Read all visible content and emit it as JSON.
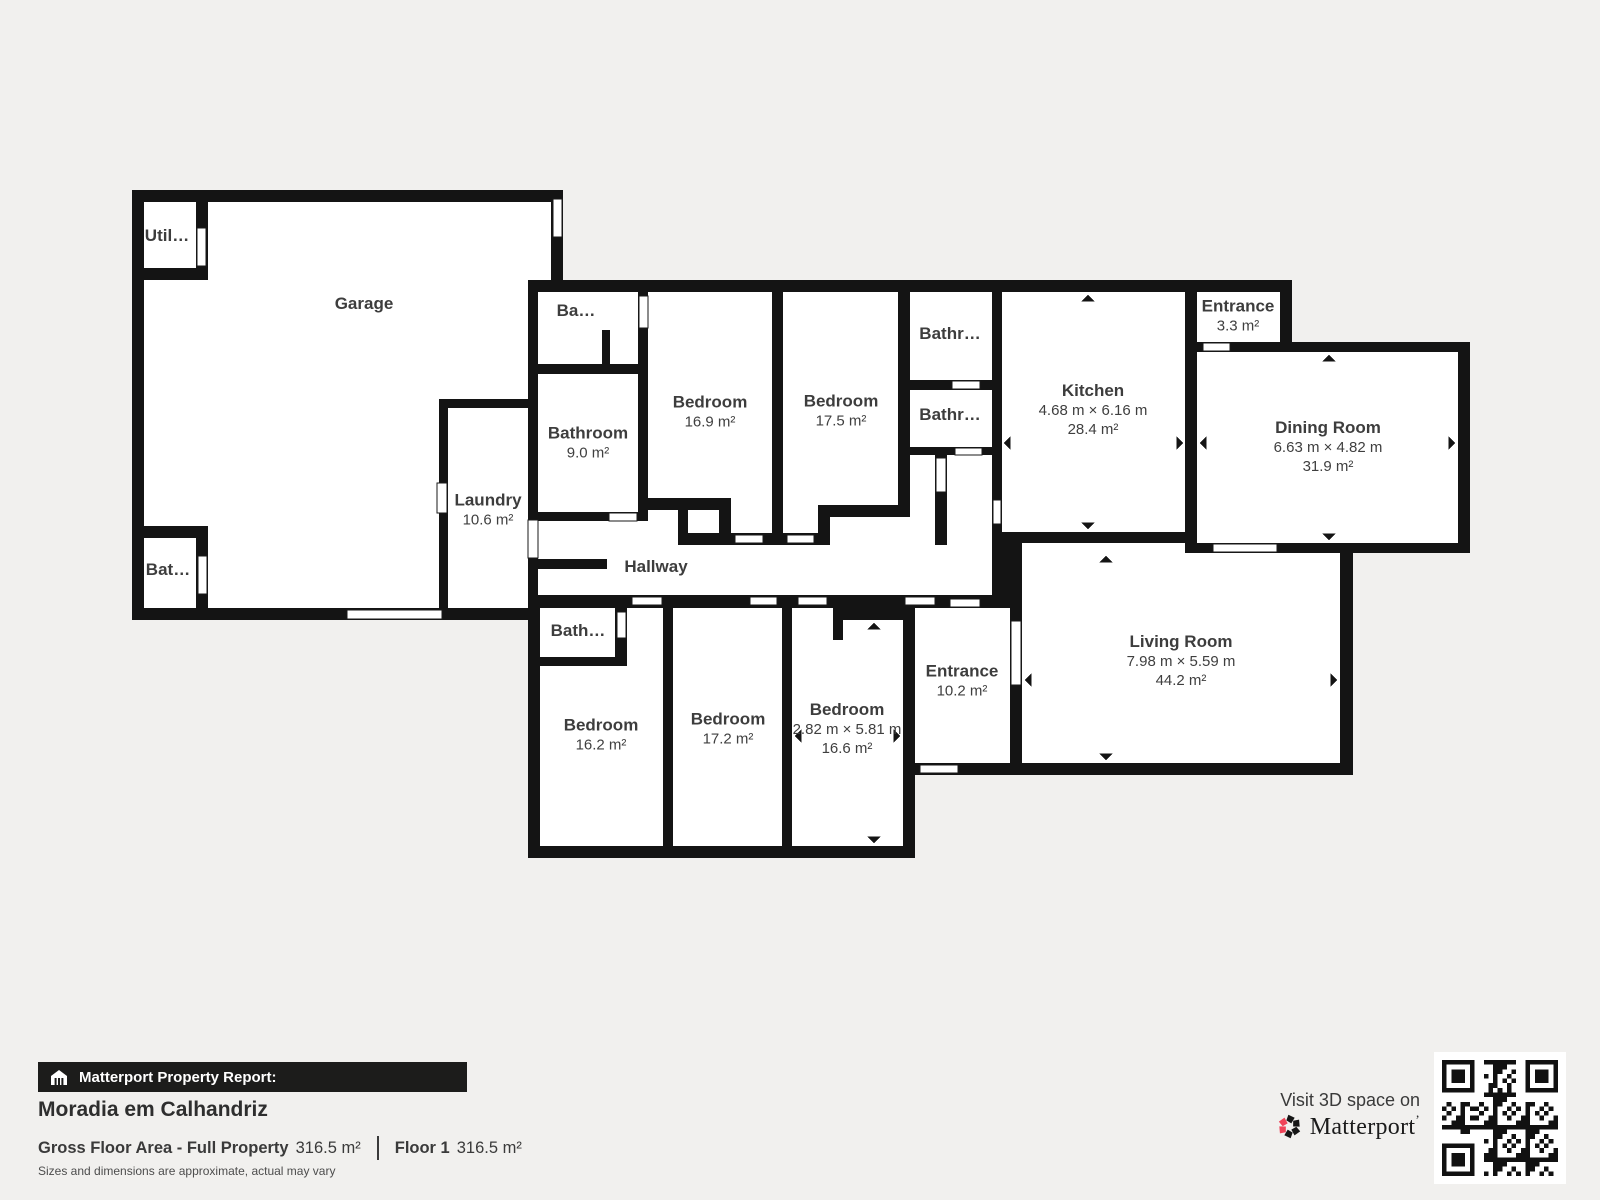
{
  "plan": {
    "rooms": {
      "garage": {
        "label": "Garage"
      },
      "utility": {
        "label": "Util…"
      },
      "garage_bath": {
        "label": "Bat…"
      },
      "laundry": {
        "label": "Laundry",
        "area": "10.6 m²"
      },
      "balcony": {
        "label": "Ba…"
      },
      "bathroom_main": {
        "label": "Bathroom",
        "area": "9.0 m²"
      },
      "bedroom_1": {
        "label": "Bedroom",
        "area": "16.9 m²"
      },
      "bedroom_2": {
        "label": "Bedroom",
        "area": "17.5 m²"
      },
      "bathroom_top": {
        "label": "Bathr…"
      },
      "bathroom_mid": {
        "label": "Bathr…"
      },
      "kitchen": {
        "label": "Kitchen",
        "dims": "4.68 m × 6.16 m",
        "area": "28.4 m²"
      },
      "entrance_small": {
        "label": "Entrance",
        "area": "3.3 m²"
      },
      "dining": {
        "label": "Dining Room",
        "dims": "6.63 m × 4.82 m",
        "area": "31.9 m²"
      },
      "hallway": {
        "label": "Hallway"
      },
      "bath_lower": {
        "label": "Bath…"
      },
      "bedroom_3": {
        "label": "Bedroom",
        "area": "16.2 m²"
      },
      "bedroom_4": {
        "label": "Bedroom",
        "area": "17.2 m²"
      },
      "bedroom_5": {
        "label": "Bedroom",
        "dims": "2.82 m × 5.81 m",
        "area": "16.6 m²"
      },
      "entrance_main": {
        "label": "Entrance",
        "area": "10.2 m²"
      },
      "living": {
        "label": "Living Room",
        "dims": "7.98 m × 5.59 m",
        "area": "44.2 m²"
      }
    }
  },
  "footer": {
    "report_label": "Matterport Property Report:",
    "property_name": "Moradia em Calhandriz",
    "gross_label": "Gross Floor Area - Full Property",
    "gross_value": "316.5 m²",
    "floor_label": "Floor 1",
    "floor_value": "316.5 m²",
    "disclaimer": "Sizes and dimensions are approximate, actual may vary"
  },
  "cta": {
    "visit_text": "Visit 3D space on",
    "brand": "Matterport",
    "mark": "’"
  },
  "colors": {
    "wall": "#141414",
    "room": "#ffffff",
    "background": "#f1f0ee",
    "label": "#3d3d3d",
    "accent_red": "#ef4358"
  }
}
